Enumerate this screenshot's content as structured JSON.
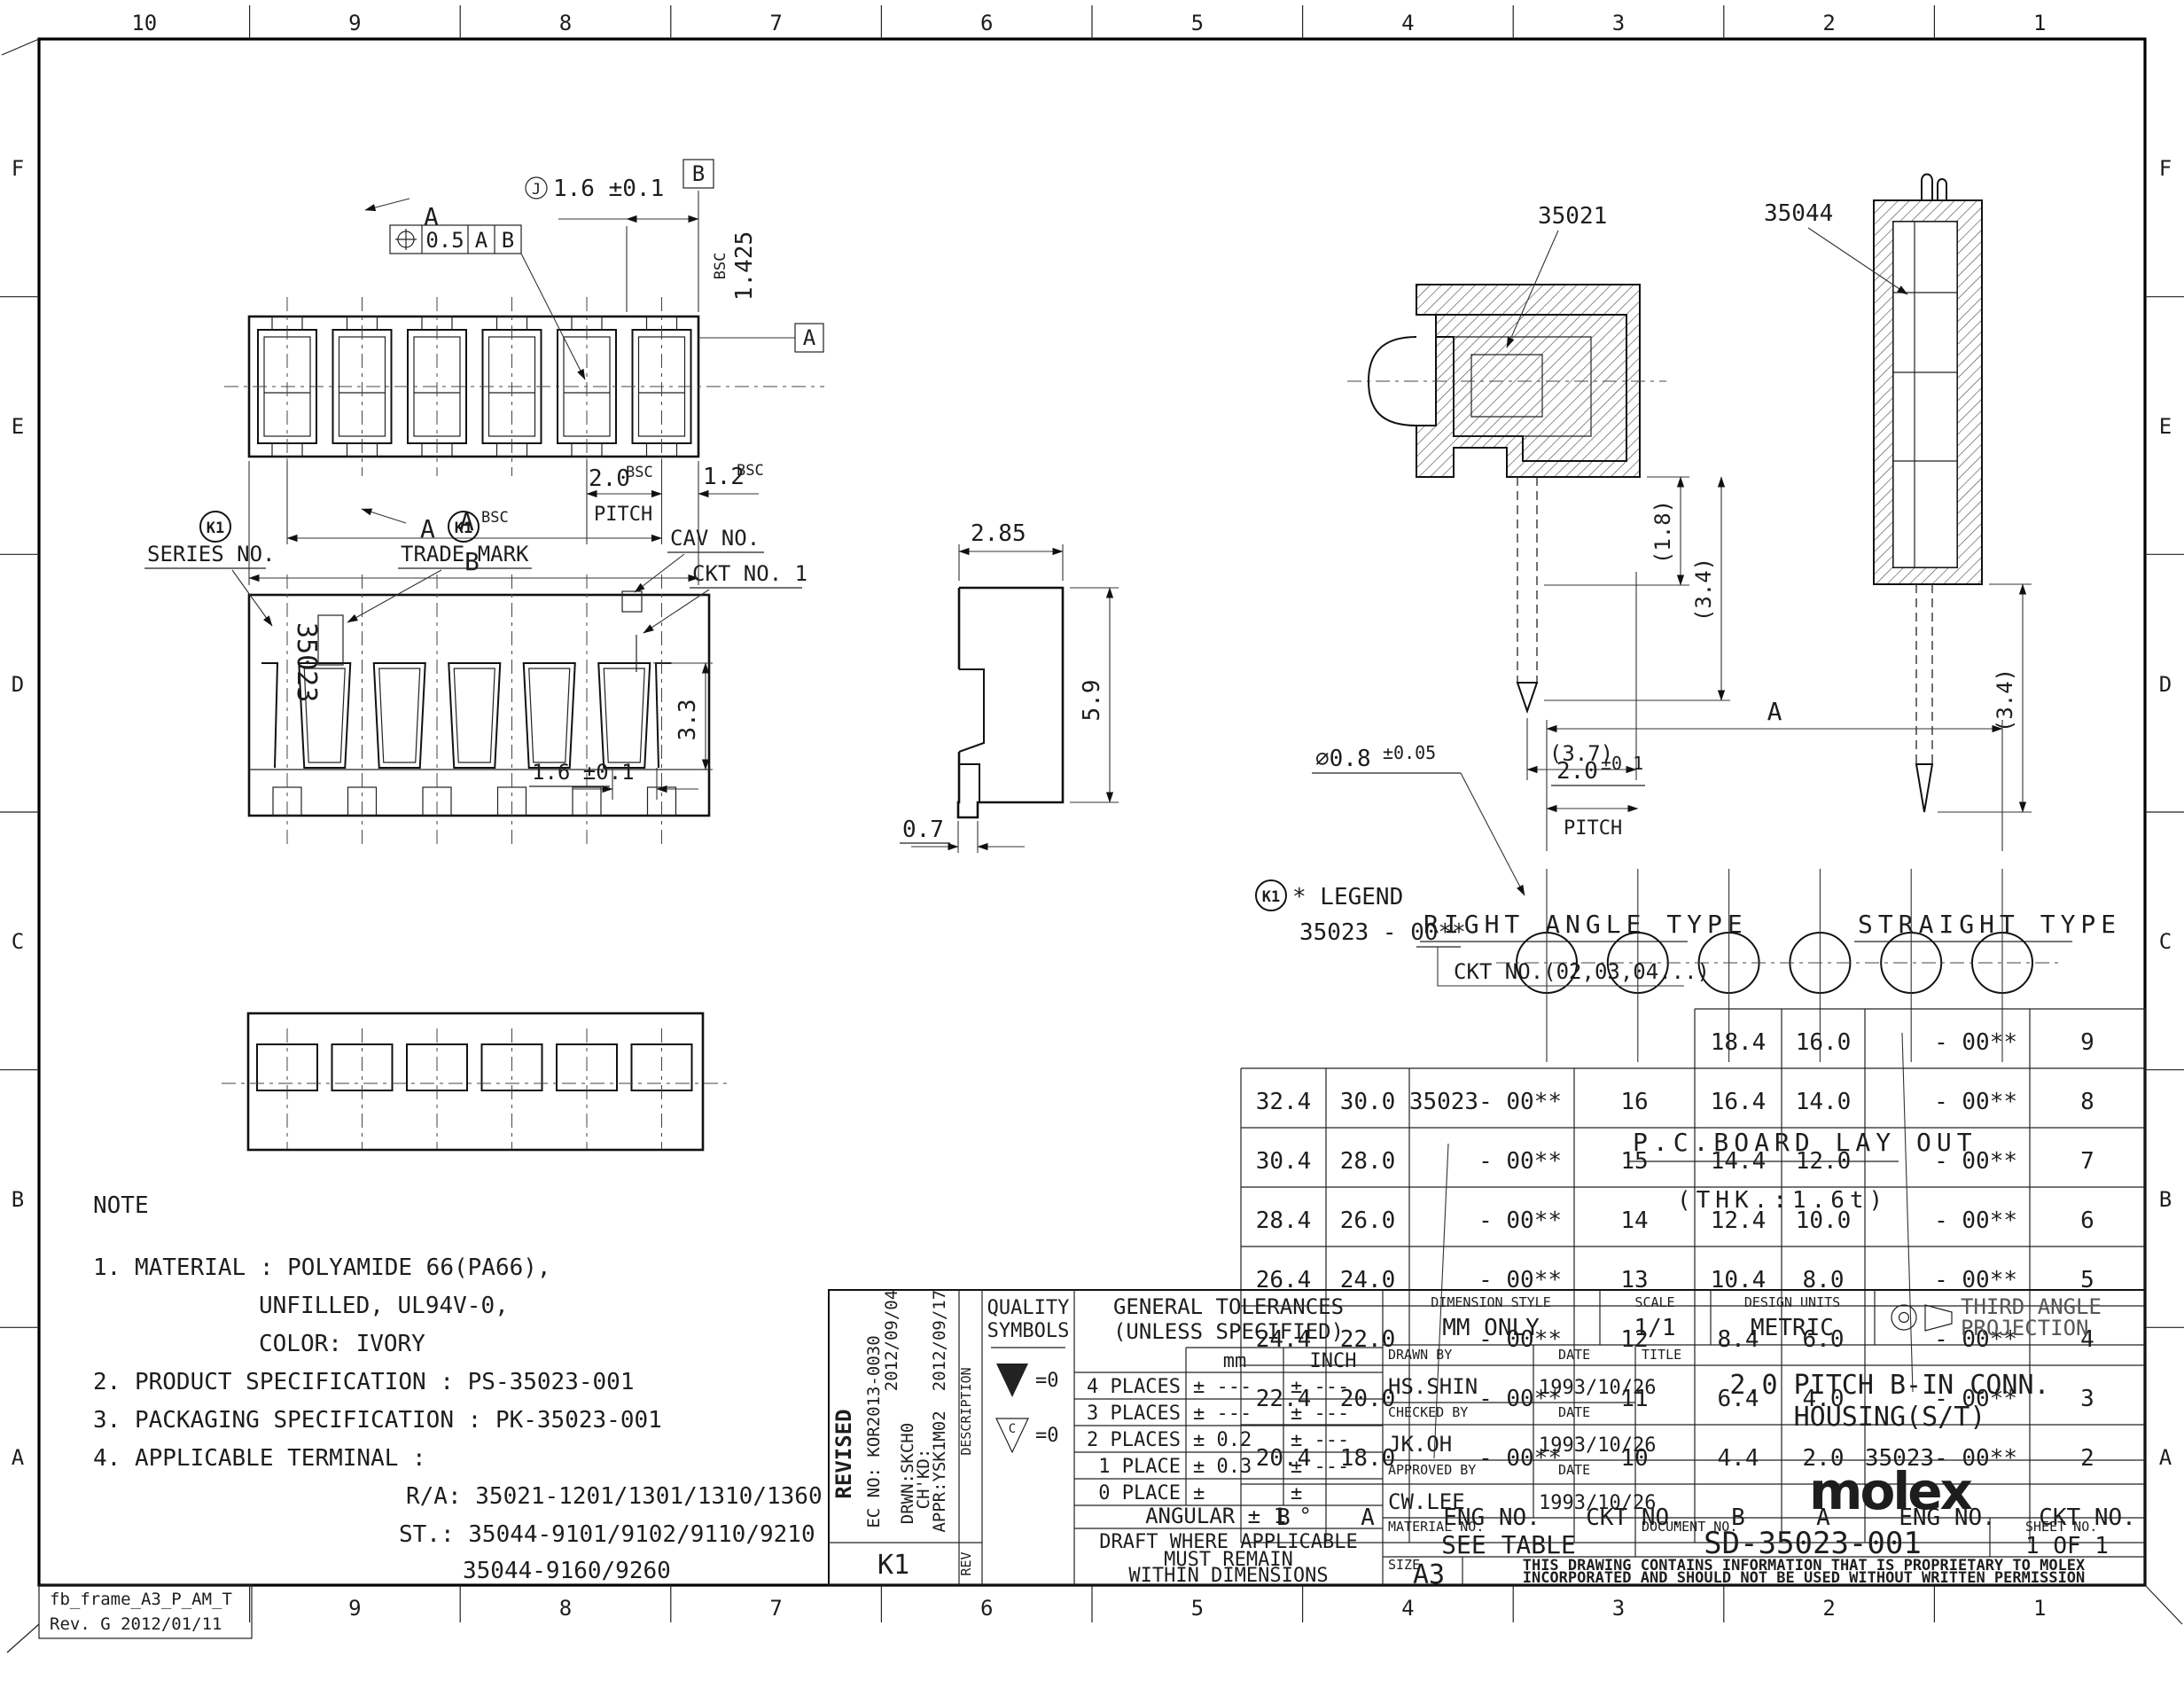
{
  "sheet": {
    "cols_top": [
      "10",
      "9",
      "8",
      "7",
      "6",
      "5",
      "4",
      "3",
      "2",
      "1"
    ],
    "cols_bottom": [
      "9",
      "8",
      "7",
      "6",
      "5",
      "4",
      "3",
      "2",
      "1"
    ],
    "rows_side": [
      "F",
      "E",
      "D",
      "C",
      "B",
      "A"
    ],
    "frame_name": "fb_frame_A3_P_AM_T",
    "frame_rev": "Rev. G 2012/01/11"
  },
  "note": {
    "heading": "NOTE",
    "lines": [
      "1. MATERIAL : POLYAMIDE 66(PA66),",
      "UNFILLED, UL94V-0,",
      "COLOR: IVORY",
      "2. PRODUCT SPECIFICATION : PS-35023-001",
      "3. PACKAGING SPECIFICATION : PK-35023-001",
      "4. APPLICABLE TERMINAL :",
      "R/A: 35021-1201/1301/1310/1360",
      "ST.: 35044-9101/9102/9110/9210",
      "35044-9160/9260"
    ]
  },
  "top_view": {
    "fcf_value": "0.5",
    "fcf_d1": "A",
    "fcf_d2": "B",
    "cj": "J",
    "d16": "1.6 ±0.1",
    "datum_a": "A",
    "datum_b": "B",
    "bsc": "BSC",
    "d1425": "1.425",
    "sec": "A",
    "pitch": "2.0",
    "pitch_word": "PITCH",
    "d12": "1.2",
    "dim_a": "A",
    "dim_b": "B"
  },
  "front_view": {
    "k1": "K1",
    "series": "SERIES NO.",
    "trade": "TRADE MARK",
    "part_no": "35023",
    "cav": "CAV NO.",
    "ckt": "CKT NO. 1",
    "d33": "3.3"
  },
  "side_view": {
    "d285": "2.85",
    "d59": "5.9",
    "d07": "0.7"
  },
  "right_angle": {
    "label": "35021",
    "d18": "(1.8)",
    "d34": "(3.4)",
    "d37": "(3.7)",
    "caption": "RIGHT ANGLE TYPE"
  },
  "straight": {
    "label": "35044",
    "d34": "(3.4)",
    "caption": "STRAIGHT TYPE"
  },
  "pcb": {
    "dia": "∅0.8",
    "dia_tol": "±0.05",
    "pitch": "2.0",
    "pitch_tol": "±0.1",
    "pitch_word": "PITCH",
    "dim_a": "A",
    "caption": "P.C.BOARD LAY OUT",
    "thk": "(THK.:1.6t)"
  },
  "legend": {
    "k1": "K1",
    "title": "* LEGEND",
    "part": "35023 - 00**",
    "ckt": "CKT NO.(02,03,04...)"
  },
  "part_table": {
    "headers": [
      "B",
      "A",
      "ENG NO.",
      "CKT NO."
    ],
    "right_rows": [
      [
        "18.4",
        "16.0",
        "- 00**",
        "9"
      ],
      [
        "16.4",
        "14.0",
        "- 00**",
        "8"
      ],
      [
        "14.4",
        "12.0",
        "- 00**",
        "7"
      ],
      [
        "12.4",
        "10.0",
        "- 00**",
        "6"
      ],
      [
        "10.4",
        "8.0",
        "- 00**",
        "5"
      ],
      [
        "8.4",
        "6.0",
        "- 00**",
        "4"
      ],
      [
        "6.4",
        "4.0",
        "- 00**",
        "3"
      ],
      [
        "4.4",
        "2.0",
        "35023- 00**",
        "2"
      ]
    ],
    "left_rows": [
      [
        "32.4",
        "30.0",
        "35023- 00**",
        "16"
      ],
      [
        "30.4",
        "28.0",
        "- 00**",
        "15"
      ],
      [
        "28.4",
        "26.0",
        "- 00**",
        "14"
      ],
      [
        "26.4",
        "24.0",
        "- 00**",
        "13"
      ],
      [
        "24.4",
        "22.0",
        "- 00**",
        "12"
      ],
      [
        "22.4",
        "20.0",
        "- 00**",
        "11"
      ],
      [
        "20.4",
        "18.0",
        "- 00**",
        "10"
      ]
    ]
  },
  "title_block": {
    "revised": "REVISED",
    "ec_no": "EC NO: KOR2013-0030",
    "date1": "2012/09/04",
    "drwn": "DRWN:SKCH0",
    "chkd": "CH'KD:",
    "appr": "APPR:YSK1M02",
    "date2": "2012/09/17",
    "description": "DESCRIPTION",
    "rev": "REV",
    "rev_id": "K1",
    "quality1": "QUALITY",
    "quality2": "SYMBOLS",
    "q1_eq": "=0",
    "q2_letter": "C",
    "q2_eq": "=0",
    "tol_title1": "GENERAL TOLERANCES",
    "tol_title2": "(UNLESS SPECIFIED)",
    "col_mm": "mm",
    "col_inch": "INCH",
    "tol_rows": [
      [
        "4 PLACES",
        "± ---",
        "± ---"
      ],
      [
        "3 PLACES",
        "± ---",
        "± ---"
      ],
      [
        "2 PLACES",
        "± 0.2",
        "± ---"
      ],
      [
        "1 PLACE",
        "± 0.3",
        "± ---"
      ],
      [
        "0 PLACE",
        "±",
        "±"
      ]
    ],
    "angular": "ANGULAR ± 1 °",
    "draft1": "DRAFT WHERE APPLICABLE",
    "draft2": "MUST REMAIN",
    "draft3": "WITHIN DIMENSIONS",
    "dim_style_label": "DIMENSION STYLE",
    "dim_style": "MM ONLY",
    "scale_label": "SCALE",
    "scale": "1/1",
    "units_label": "DESIGN UNITS",
    "units": "METRIC",
    "proj1": "THIRD ANGLE",
    "proj2": "PROJECTION",
    "drawn_label": "DRAWN BY",
    "drawn": "HS.SHIN",
    "checked_label": "CHECKED BY",
    "checked": "JK.OH",
    "approved_label": "APPROVED BY",
    "approved": "CW.LEE",
    "date_label": "DATE",
    "date_value": "1993/10/26",
    "title_label": "TITLE",
    "title1": "2.0 PITCH B-IN CONN.",
    "title2": "HOUSING(S/T)",
    "logo": "molex",
    "material_label": "MATERIAL NO.",
    "material": "SEE TABLE",
    "doc_label": "DOCUMENT NO.",
    "doc_no": "SD-35023-001",
    "sheet_label": "SHEET NO.",
    "sheet_no": "1 OF 1",
    "size_label": "SIZE",
    "size": "A3",
    "prop1": "THIS DRAWING CONTAINS INFORMATION THAT IS PROPRIETARY TO MOLEX",
    "prop2": "INCORPORATED AND SHOULD NOT BE USED WITHOUT WRITTEN PERMISSION"
  }
}
